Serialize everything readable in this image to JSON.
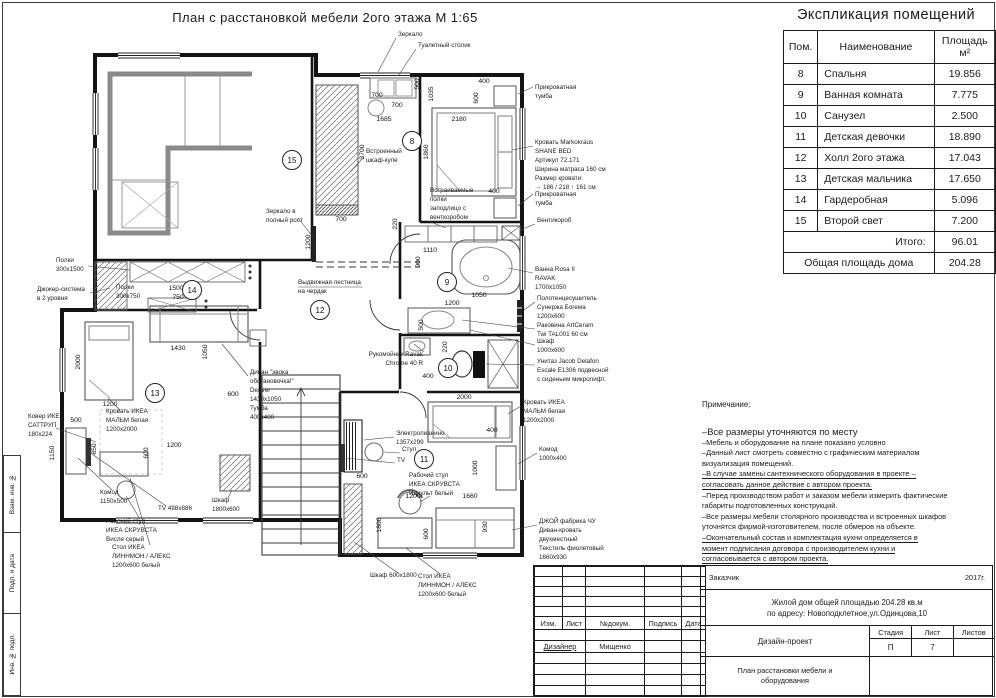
{
  "page": {
    "plan_title": "План с расстановкой мебели  2ого этажа М 1:65",
    "strip_labels": [
      "Взам. инв. №",
      "Подп. и дата",
      "Инв. № подл."
    ]
  },
  "legend": {
    "title": "Экспликация помещений",
    "col_num": "Пом.",
    "col_name": "Наименование",
    "col_area": "Площадь\nм²",
    "rows": [
      {
        "num": "8",
        "name": "Спальня",
        "area": "19.856"
      },
      {
        "num": "9",
        "name": "Ванная комната",
        "area": "7.775"
      },
      {
        "num": "10",
        "name": "Санузел",
        "area": "2.500"
      },
      {
        "num": "11",
        "name": "Детская девочки",
        "area": "18.890"
      },
      {
        "num": "12",
        "name": "Холл 2ого этажа",
        "area": "17.043"
      },
      {
        "num": "13",
        "name": "Детская мальчика",
        "area": "17.650"
      },
      {
        "num": "14",
        "name": "Гардеробная",
        "area": "5.096"
      },
      {
        "num": "15",
        "name": "Второй свет",
        "area": "7.200"
      }
    ],
    "subtotal": {
      "label": "Итого:",
      "value": "96.01"
    },
    "total": {
      "label": "Общая площадь дома",
      "value": "204.28"
    }
  },
  "notes": {
    "heading": "Примечание:",
    "lines": [
      {
        "t": "–Все размеры уточняются по месту",
        "big": true
      },
      {
        "t": "–Мебель и оборудование на плане показано условно"
      },
      {
        "t": "–Данный лист смотреть совместно с графическим материалом"
      },
      {
        "t": "визуализация помещений."
      },
      {
        "t": "–В случае замены сантехнического оборудования в проекте –",
        "u": true
      },
      {
        "t": "согласовать данное действие с автором проекта.",
        "u": true
      },
      {
        "t": "–Перед производством работ и заказом мебели измерить фактические"
      },
      {
        "t": "габариты подготовленных конструкций."
      },
      {
        "t": "–Все размеры мебели столярного производства и встроенных шкафов"
      },
      {
        "t": "уточнятся фирмой-изготовителем, после обмеров на объекте."
      },
      {
        "t": "–Окончательный состав и комплектация кухни определяется в",
        "u": true
      },
      {
        "t": "момент подписания договора с производителем кухни и",
        "u": true
      },
      {
        "t": "согласовывается с автором проекта.",
        "u": true
      }
    ]
  },
  "titleblock": {
    "customer": "Заказчик",
    "year": "2017г.",
    "object_line1": "Жилой дом общей площадью 204.28 кв.м",
    "object_line2": "по адресу: Новоподклетное,ул.Одинцова,10",
    "cols": [
      "Изм.",
      "Лист",
      "№докум.",
      "Подпись",
      "Дата"
    ],
    "role": "Дизайнер",
    "name": "Мищенко",
    "project": "Дизайн-проект",
    "stage_h": "Стадия",
    "sheet_h": "Лист",
    "sheets_h": "Листов",
    "stage": "П",
    "sheet": "7",
    "sheets": "",
    "doc_line1": "План расстановки мебели и",
    "doc_line2": "оборудования"
  },
  "plan": {
    "circles": [
      {
        "n": "8",
        "x": 412,
        "y": 141
      },
      {
        "n": "9",
        "x": 447,
        "y": 282
      },
      {
        "n": "10",
        "x": 448,
        "y": 368
      },
      {
        "n": "11",
        "x": 424,
        "y": 459
      },
      {
        "n": "12",
        "x": 320,
        "y": 310
      },
      {
        "n": "13",
        "x": 155,
        "y": 393
      },
      {
        "n": "14",
        "x": 192,
        "y": 290
      },
      {
        "n": "15",
        "x": 292,
        "y": 160
      }
    ],
    "dims": [
      {
        "t": "700",
        "x": 377,
        "y": 97
      },
      {
        "t": "700",
        "x": 397,
        "y": 107
      },
      {
        "t": "500",
        "x": 419,
        "y": 84,
        "r": 1
      },
      {
        "t": "1035",
        "x": 433,
        "y": 94,
        "r": 1
      },
      {
        "t": "600",
        "x": 478,
        "y": 98,
        "r": 1
      },
      {
        "t": "400",
        "x": 484,
        "y": 83
      },
      {
        "t": "1685",
        "x": 384,
        "y": 121
      },
      {
        "t": "2180",
        "x": 459,
        "y": 121
      },
      {
        "t": "3700",
        "x": 364,
        "y": 152,
        "r": 1
      },
      {
        "t": "1860",
        "x": 428,
        "y": 152,
        "r": 1
      },
      {
        "t": "700",
        "x": 341,
        "y": 221
      },
      {
        "t": "220",
        "x": 397,
        "y": 224,
        "r": 1
      },
      {
        "t": "1110",
        "x": 430,
        "y": 252
      },
      {
        "t": "1200",
        "x": 310,
        "y": 242,
        "r": 1
      },
      {
        "t": "400",
        "x": 494,
        "y": 193
      },
      {
        "t": "900",
        "x": 420,
        "y": 262,
        "r": 1
      },
      {
        "t": "1050",
        "x": 479,
        "y": 297
      },
      {
        "t": "1200",
        "x": 452,
        "y": 305
      },
      {
        "t": "500",
        "x": 423,
        "y": 325,
        "r": 1
      },
      {
        "t": "220",
        "x": 447,
        "y": 347,
        "r": 1
      },
      {
        "t": "400",
        "x": 428,
        "y": 378
      },
      {
        "t": "2000",
        "x": 464,
        "y": 399
      },
      {
        "t": "1500",
        "x": 176,
        "y": 290
      },
      {
        "t": "750",
        "x": 178,
        "y": 299
      },
      {
        "t": "2000",
        "x": 80,
        "y": 362,
        "r": 1
      },
      {
        "t": "1200",
        "x": 110,
        "y": 406
      },
      {
        "t": "500",
        "x": 76,
        "y": 422
      },
      {
        "t": "1430",
        "x": 178,
        "y": 350
      },
      {
        "t": "1050",
        "x": 207,
        "y": 352,
        "r": 1
      },
      {
        "t": "600",
        "x": 233,
        "y": 396
      },
      {
        "t": "1150",
        "x": 54,
        "y": 453,
        "r": 1
      },
      {
        "t": "850",
        "x": 96,
        "y": 449,
        "r": 1
      },
      {
        "t": "600",
        "x": 148,
        "y": 453,
        "r": 1
      },
      {
        "t": "1200",
        "x": 174,
        "y": 447
      },
      {
        "t": "400",
        "x": 492,
        "y": 432
      },
      {
        "t": "1000",
        "x": 477,
        "y": 468,
        "r": 1
      },
      {
        "t": "600",
        "x": 362,
        "y": 478
      },
      {
        "t": "1200",
        "x": 413,
        "y": 498
      },
      {
        "t": "1660",
        "x": 470,
        "y": 498
      },
      {
        "t": "1800",
        "x": 381,
        "y": 525,
        "r": 1
      },
      {
        "t": "600",
        "x": 428,
        "y": 534,
        "r": 1
      },
      {
        "t": "930",
        "x": 487,
        "y": 527,
        "r": 1
      }
    ],
    "labels": [
      {
        "t": [
          "Зеркало"
        ],
        "x": 398,
        "y": 36,
        "ld": [
          396,
          38,
          378,
          72
        ]
      },
      {
        "t": [
          "Туалетный столик"
        ],
        "x": 418,
        "y": 47,
        "ld": [
          416,
          49,
          398,
          76
        ]
      },
      {
        "t": [
          "Прикроватная",
          "тумба"
        ],
        "x": 535,
        "y": 89,
        "ld": [
          533,
          87,
          518,
          94
        ]
      },
      {
        "t": [
          "Кровать Markokraus",
          "SHANE BED",
          "Артикул 72.171",
          "Ширина матраса 160 см",
          "Размер кровати:",
          "→ 186 / 218 ↑ 161 см"
        ],
        "x": 535,
        "y": 144,
        "ld": [
          533,
          146,
          512,
          150
        ]
      },
      {
        "t": [
          "Прикроватная",
          "тумба"
        ],
        "x": 535,
        "y": 196,
        "ld": [
          533,
          194,
          518,
          206
        ]
      },
      {
        "t": [
          "Вентикороб"
        ],
        "x": 537,
        "y": 222,
        "ld": [
          535,
          224,
          520,
          230
        ]
      },
      {
        "t": [
          "Ванна Rosa II",
          "RAVAK",
          "1700x1050"
        ],
        "x": 535,
        "y": 271,
        "ld": [
          533,
          273,
          508,
          268
        ]
      },
      {
        "t": [
          "Полотенцесушитель",
          "Сунержа Богема",
          "1200x600"
        ],
        "x": 537,
        "y": 300,
        "ld": [
          535,
          302,
          524,
          310
        ]
      },
      {
        "t": [
          "Раковина ArtCeram",
          "Twi TAL001 60 см"
        ],
        "x": 537,
        "y": 327,
        "ld": [
          535,
          329,
          462,
          320
        ]
      },
      {
        "t": [
          "Шкаф",
          "1000x600"
        ],
        "x": 537,
        "y": 343,
        "ld": [
          535,
          345,
          470,
          330
        ]
      },
      {
        "t": [
          "Унитаз Jacob Delafon",
          "Escale E1306 подвесной",
          "с сиденьем микролифт."
        ],
        "x": 537,
        "y": 363,
        "ld": [
          535,
          365,
          486,
          364
        ]
      },
      {
        "t": [
          "Кровать ИКЕА",
          "МАЛЬМ белая",
          "1200x2000"
        ],
        "x": 523,
        "y": 404,
        "ld": [
          521,
          406,
          508,
          414
        ]
      },
      {
        "t": [
          "Комод",
          "1000x400"
        ],
        "x": 539,
        "y": 451,
        "ld": [
          537,
          453,
          518,
          464
        ]
      },
      {
        "t": [
          "ДЖОЙ фабрика ЧУ",
          "Диван-кровать",
          "двухместный",
          "Текстиль фиолетовый",
          "1660x930"
        ],
        "x": 539,
        "y": 523,
        "ld": [
          537,
          525,
          512,
          530
        ]
      },
      {
        "t": [
          "Полки",
          "300x1500"
        ],
        "x": 56,
        "y": 262,
        "ld": [
          88,
          266,
          130,
          270
        ]
      },
      {
        "t": [
          "Джокер-система",
          "в 2 уровня"
        ],
        "x": 37,
        "y": 291,
        "ld": [
          90,
          293,
          110,
          288
        ]
      },
      {
        "t": [
          "Полки",
          "300x750"
        ],
        "x": 116,
        "y": 289
      },
      {
        "t": [
          "Ковер ИКЕА",
          "САТТРУП",
          "180x224"
        ],
        "x": 28,
        "y": 418,
        "ld": [
          56,
          428,
          96,
          442
        ]
      },
      {
        "t": [
          "Комод",
          "1150x500"
        ],
        "x": 100,
        "y": 494,
        "ld": [
          112,
          490,
          78,
          458
        ]
      },
      {
        "t": [
          "TV 498x886"
        ],
        "x": 158,
        "y": 510,
        "ld": [
          166,
          506,
          92,
          454
        ]
      },
      {
        "t": [
          "Рабочий стул",
          "ИКЕА СКРУВСТА",
          "Висле серый"
        ],
        "x": 106,
        "y": 523,
        "ld": [
          140,
          519,
          126,
          496
        ]
      },
      {
        "t": [
          "Стол ИКЕА",
          "ЛИННМОН / АЛЕКС",
          "1200x600 белый"
        ],
        "x": 112,
        "y": 549,
        "ld": [
          150,
          545,
          130,
          478
        ]
      },
      {
        "t": [
          "Кровать ИКЕА",
          "МАЛЬМ белая",
          "1200x2000"
        ],
        "x": 106,
        "y": 413,
        "ld": [
          120,
          410,
          108,
          398
        ]
      },
      {
        "t": [
          "Шкаф",
          "1800x600"
        ],
        "x": 212,
        "y": 502,
        "ld": [
          228,
          498,
          232,
          490
        ]
      },
      {
        "t": [
          "Шкаф 600x1800"
        ],
        "x": 370,
        "y": 577,
        "ld": [
          398,
          573,
          354,
          542
        ]
      },
      {
        "t": [
          "Стол ИКЕА",
          "ЛИННМОН / АЛЕКС",
          "1200x600 белый"
        ],
        "x": 418,
        "y": 578,
        "ld": [
          440,
          574,
          406,
          548
        ]
      },
      {
        "t": [
          "Выдвижная лестница",
          "на чердак"
        ],
        "x": 298,
        "y": 284,
        "ld": [
          298,
          287,
          362,
          287
        ]
      },
      {
        "t": [
          "Зеркало в",
          "полный рост"
        ],
        "x": 266,
        "y": 213,
        "ld": [
          298,
          218,
          314,
          238
        ]
      },
      {
        "t": [
          "Встроенный",
          "шкаф-купе"
        ],
        "x": 366,
        "y": 153,
        "ld": [
          364,
          157,
          350,
          172
        ]
      },
      {
        "t": [
          "Встраиваемые",
          "полки",
          "заподлицо с",
          "венткоробом"
        ],
        "x": 430,
        "y": 192,
        "ld": [
          428,
          221,
          446,
          228
        ]
      },
      {
        "t": [
          "Электропианино",
          "1357x299"
        ],
        "x": 396,
        "y": 435,
        "ld": [
          394,
          437,
          364,
          440
        ]
      },
      {
        "t": [
          "Стул"
        ],
        "x": 402,
        "y": 451,
        "ld": [
          400,
          453,
          384,
          452
        ]
      },
      {
        "t": [
          "TV"
        ],
        "x": 397,
        "y": 462,
        "ld": [
          395,
          463,
          346,
          458
        ]
      },
      {
        "t": [
          "Рабочий стул",
          "ИКЕА СКРУВСТА",
          "Идхульт белый"
        ],
        "x": 409,
        "y": 477,
        "ld": [
          430,
          496,
          420,
          502
        ]
      },
      {
        "t": [
          "Диван \"эвока",
          "обстановочка!\"",
          "Denver",
          "1430x1050",
          "Тумба",
          "400x400"
        ],
        "x": 250,
        "y": 374,
        "ld": [
          248,
          376,
          222,
          344
        ]
      },
      {
        "t": [
          "Рукомойник Ravak",
          "Chrome 40 R"
        ],
        "x": 423,
        "y": 356,
        "a": "e",
        "ld": [
          424,
          352,
          414,
          344
        ]
      }
    ]
  }
}
